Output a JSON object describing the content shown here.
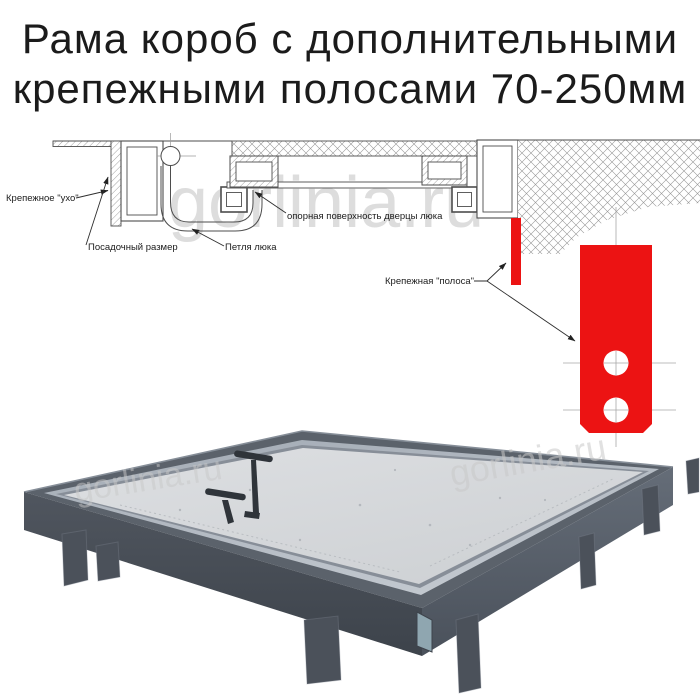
{
  "title": {
    "line1": "Рама короб с дополнительными",
    "line2": "крепежными полосами 70-250мм"
  },
  "watermark": {
    "text": "gorlinia.ru"
  },
  "diagram": {
    "labels": {
      "mounting_ear": "Крепежное \"ухо\"",
      "seating_size": "Посадочный размер",
      "hatch_hinge": "Петля люка",
      "door_support_surface": "опорная поверхность дверцы люка",
      "mounting_strip": "Крепежная \"полоса\""
    },
    "strip_size_range_mm": "70-250",
    "colors": {
      "strip_red": "#ec1313",
      "line": "#4d4d4d",
      "centerline": "#a8a8a8"
    }
  },
  "photo": {
    "colors": {
      "rim_top": "#5b626b",
      "rim_left_face": "#474d55",
      "rim_right_face": "#59616c",
      "flange": "#b0b8c1",
      "panel": "#d9dbde",
      "legs": "#4b515a",
      "handles": "#2f343a"
    }
  }
}
